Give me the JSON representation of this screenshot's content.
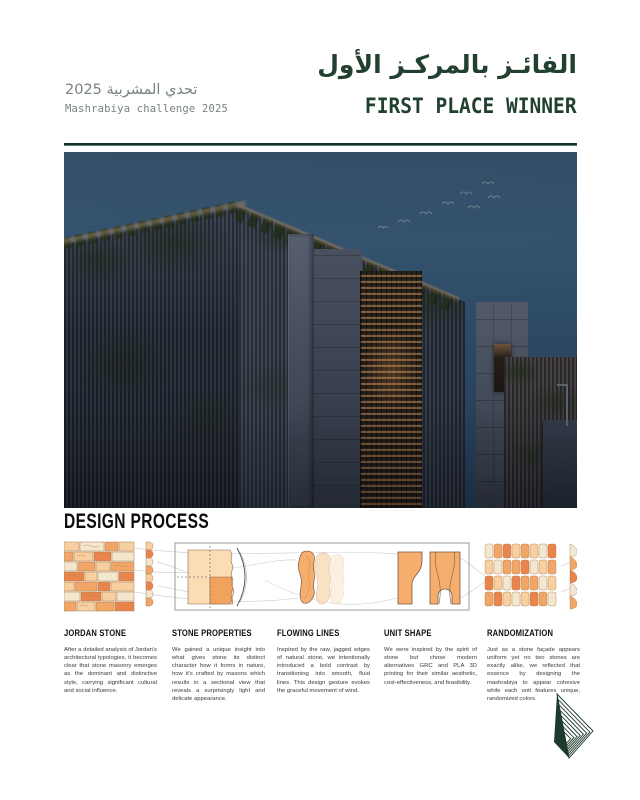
{
  "poster": {
    "brand_green": "#1f3d2e",
    "muted_gray": "#77837b",
    "header": {
      "event_title_ar": "تحدي المشربية 2025",
      "event_title_en": "Mashrabiya challenge 2025",
      "award_title_ar": "الفائـز بالمركـز الأول",
      "award_title_en": "FIRST PLACE WINNER"
    },
    "design_process": {
      "title": "DESIGN PROCESS",
      "steps": [
        {
          "label": "JORDAN STONE",
          "body": "After a detailed analysis of Jordan's architectural typologies, it becomes clear that stone masonry emerges as the dominant and distinctive style, carrying significant cultural and social influence."
        },
        {
          "label": "STONE PROPERTIES",
          "body": "We gained a unique insight into what gives stone its distinct character how it forms in nature, how it's crafted by masons which results in a sectional view that reveals a surprisingly light and delicate appearance."
        },
        {
          "label": "FLOWING LINES",
          "body": "Inspired by the raw, jagged edges of natural stone, we intentionally introduced a bold contrast by transitioning into smooth, fluid lines. This design gesture evokes the graceful movement of wind."
        },
        {
          "label": "UNIT SHAPE",
          "body": "We were inspired by the spirit of stone but chose modern alternatives GRC and PLA 3D printing for their similar aesthetic, cost-effectiveness, and feasibility."
        },
        {
          "label": "RANDOMIZATION",
          "body": "Just as a stone façade appears uniform yet no two stones are exactly alike, we reflected that essence by designing the mashrabiya to appear cohesive while each unit features unique, randomized colors."
        }
      ]
    },
    "figure_palette": {
      "cream": "#f4e7cf",
      "light_orange": "#f8cf9e",
      "orange": "#f1a566",
      "deep_orange": "#e9854a",
      "outline": "#a97f52"
    },
    "icons": {
      "logo": "striped-pyramid-logo",
      "hero": "night-render-of-mashrabiya-building"
    }
  }
}
